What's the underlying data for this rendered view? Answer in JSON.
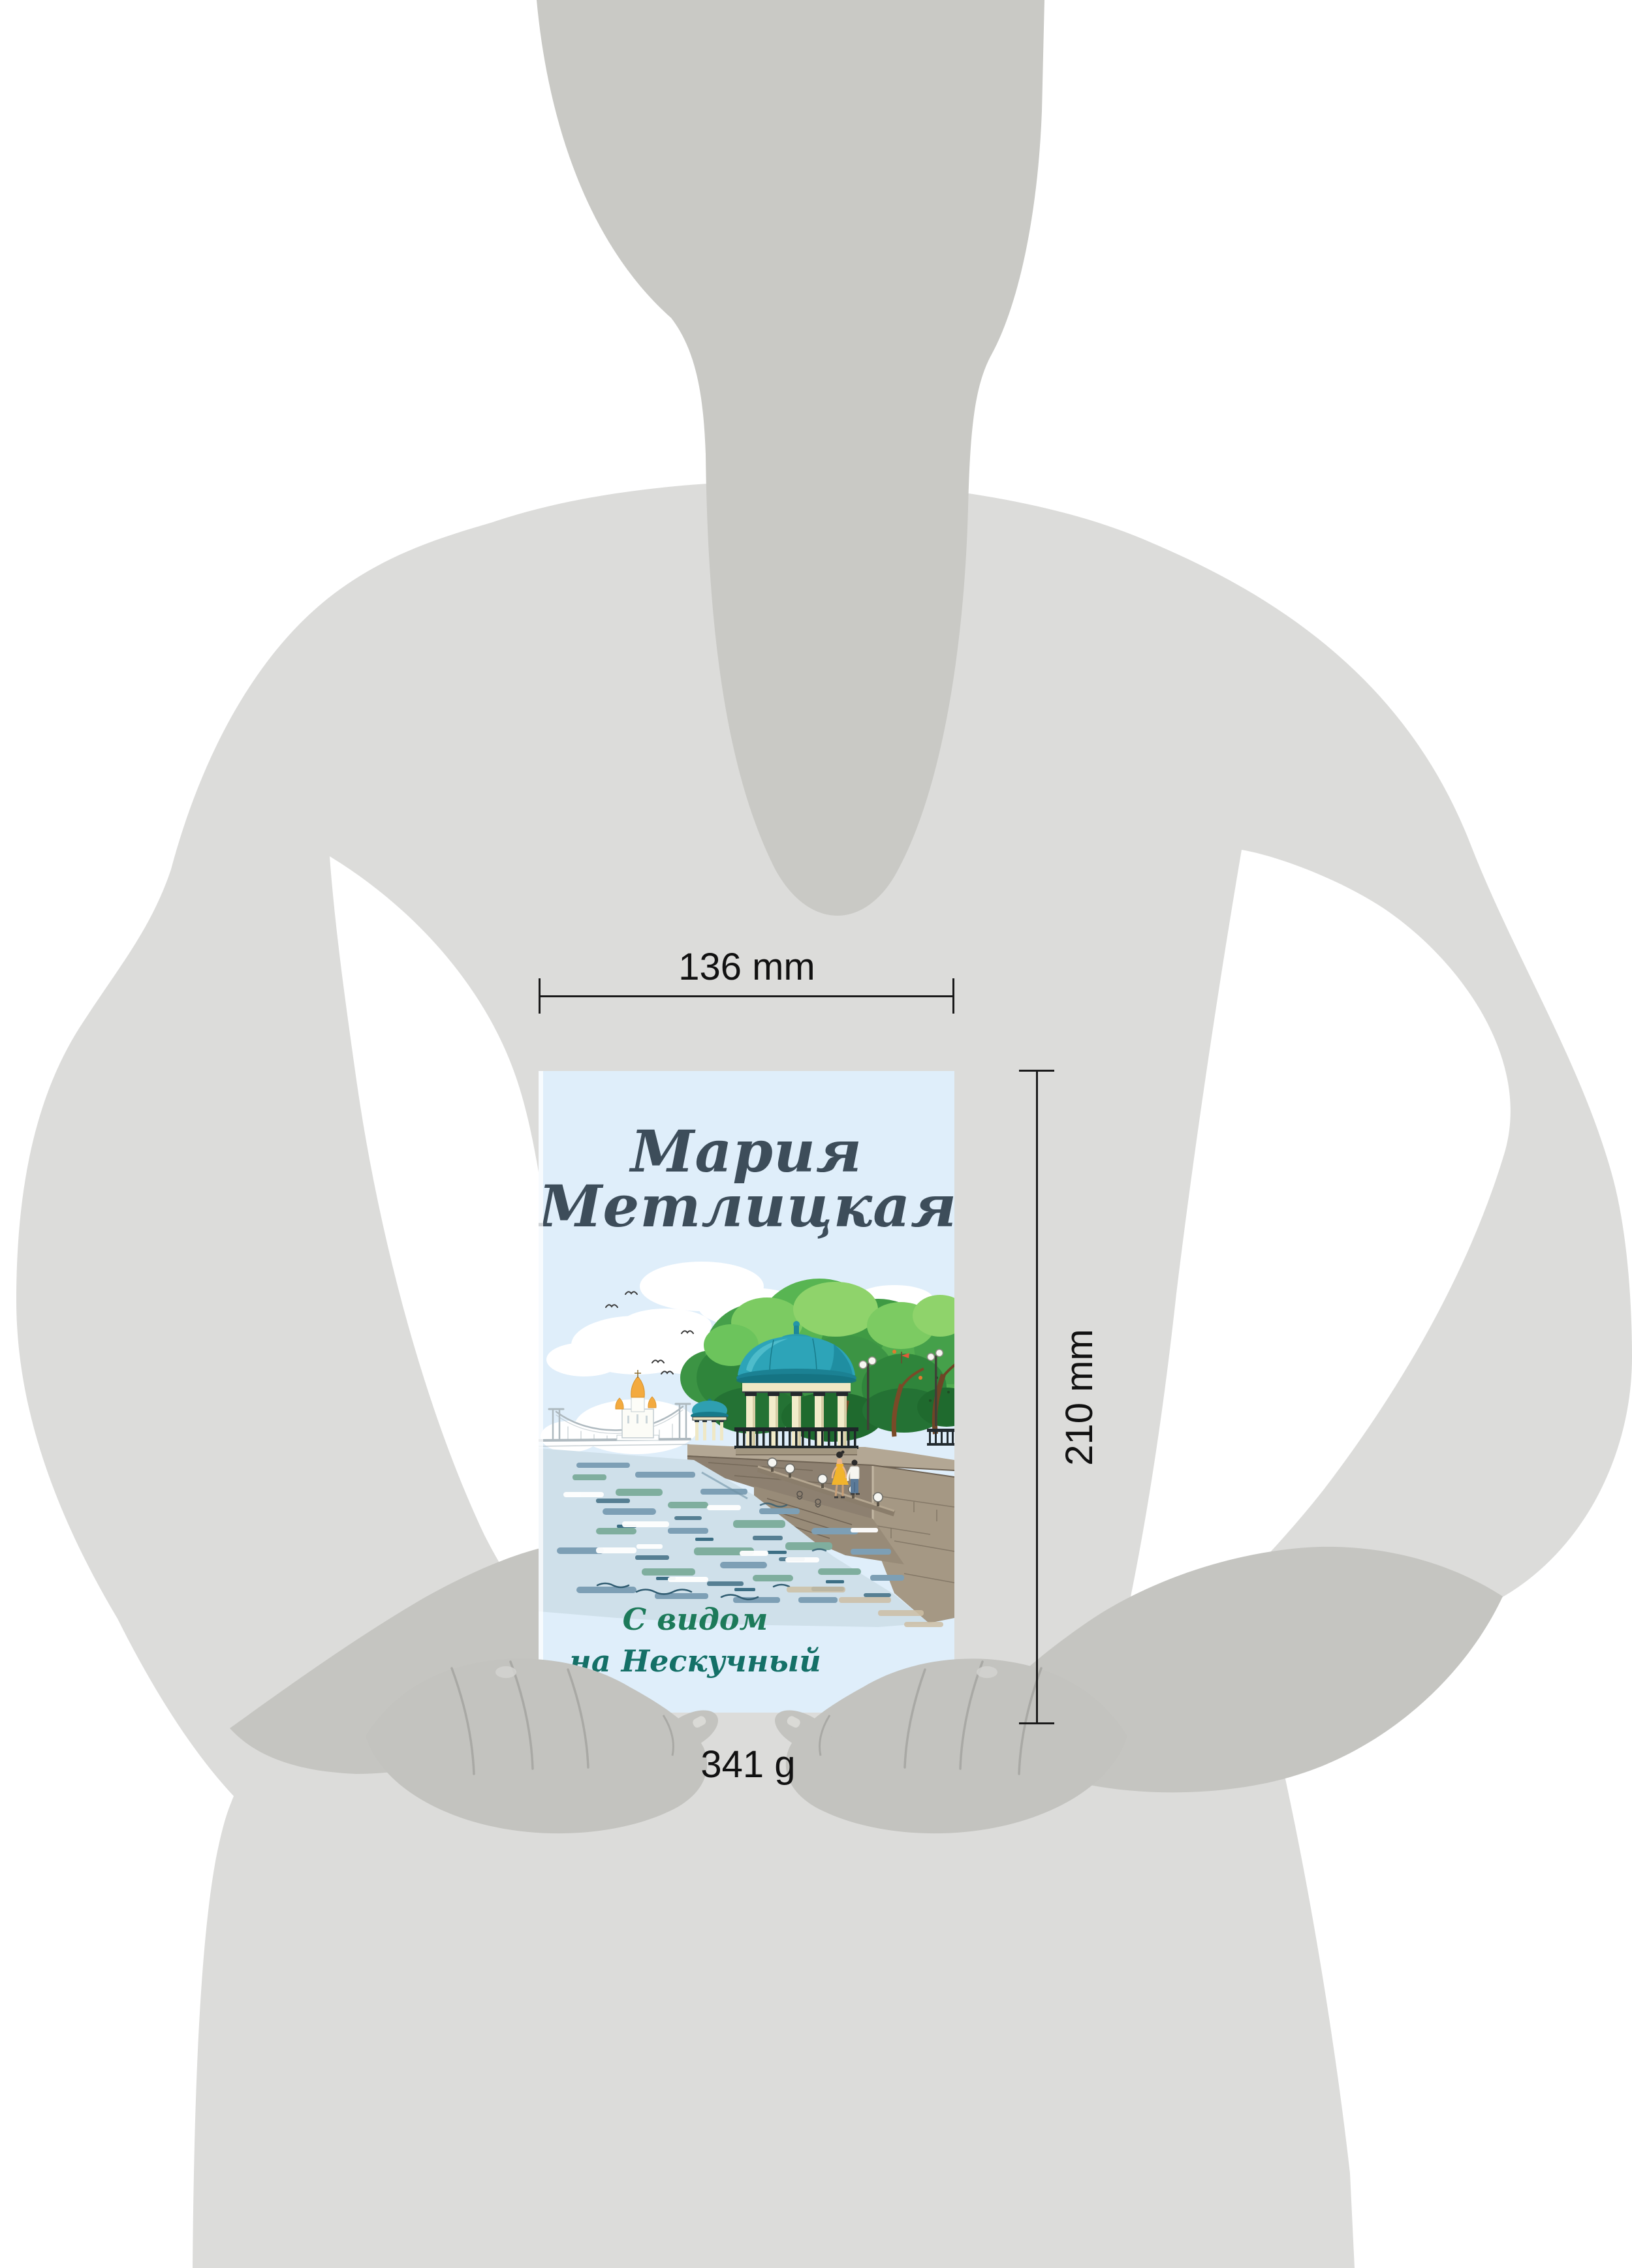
{
  "annotations": {
    "width_label": "136 mm",
    "height_label": "210 mm",
    "weight_label": "341 g",
    "line_color": "#1a1a1a"
  },
  "book": {
    "author_line1": "Мария",
    "author_line2": "Метлицкая",
    "title_line1": "С видом",
    "title_line2": "на Нескучный",
    "cover_background": "#dfeefa",
    "author_color": "#3d4d5a",
    "title_color": "#1d7a5a"
  },
  "figure": {
    "body_color": "#dcdcda",
    "neck_color": "#c9c9c5",
    "forearm_color": "#c5c5c1",
    "hand_color": "#c3c3bf"
  },
  "illustration_colors": {
    "dome_teal": "#2da4b8",
    "tree_green": "#45a04a",
    "water_blue": "#7d9fb5",
    "stone_tan": "#a59884",
    "dress_yellow": "#f2b42c",
    "church_gold": "#f3aa3f"
  }
}
